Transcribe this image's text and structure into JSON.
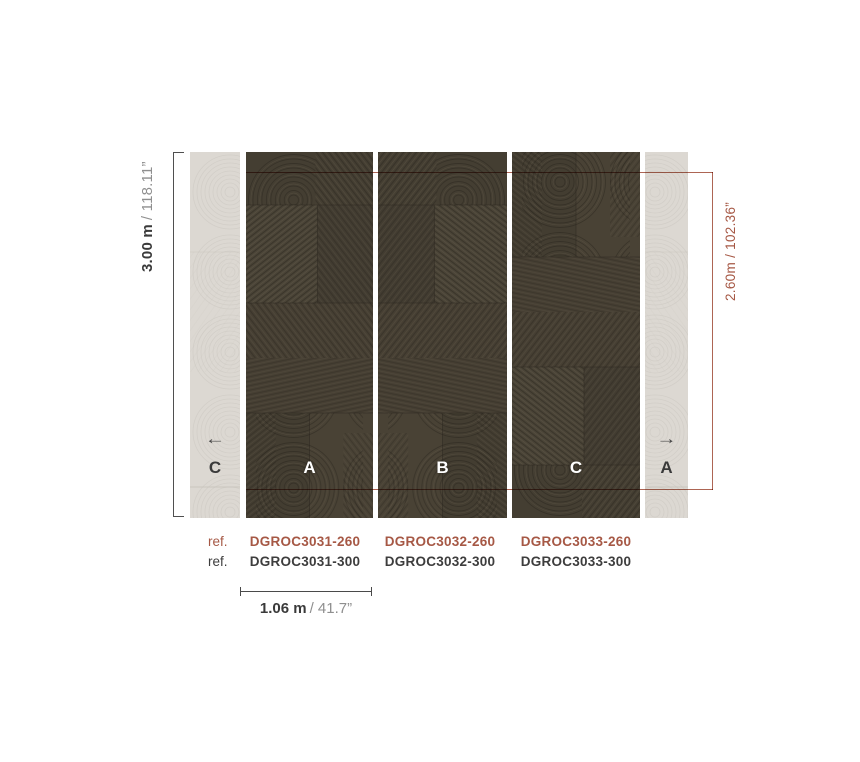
{
  "colors": {
    "accent": "#a65845",
    "panel_dark": "#474134",
    "panel_light": "#dcd8d2",
    "text_dark": "#3a3a3a",
    "text_gray": "#8f8f8f"
  },
  "dimensions": {
    "height_total": {
      "bold": "3.00 m",
      "light": "/ 118.11”"
    },
    "height_accent": "2.60m / 102.36”",
    "panel_width": {
      "bold": "1.06 m",
      "light": "/ 41.7”"
    }
  },
  "panels": [
    {
      "position": "left-partial",
      "tone": "light",
      "letter": "C",
      "arrow": "←"
    },
    {
      "position": "panel-1",
      "tone": "dark",
      "letter": "A"
    },
    {
      "position": "panel-2",
      "tone": "dark",
      "letter": "B"
    },
    {
      "position": "panel-3",
      "tone": "dark",
      "letter": "C"
    },
    {
      "position": "right-partial",
      "tone": "light",
      "letter": "A",
      "arrow": "→"
    }
  ],
  "refs": {
    "label_row_260": "ref.",
    "label_row_300": "ref.",
    "row_260": [
      "DGROC3031-260",
      "DGROC3032-260",
      "DGROC3033-260"
    ],
    "row_300": [
      "DGROC3031-300",
      "DGROC3032-300",
      "DGROC3033-300"
    ]
  }
}
